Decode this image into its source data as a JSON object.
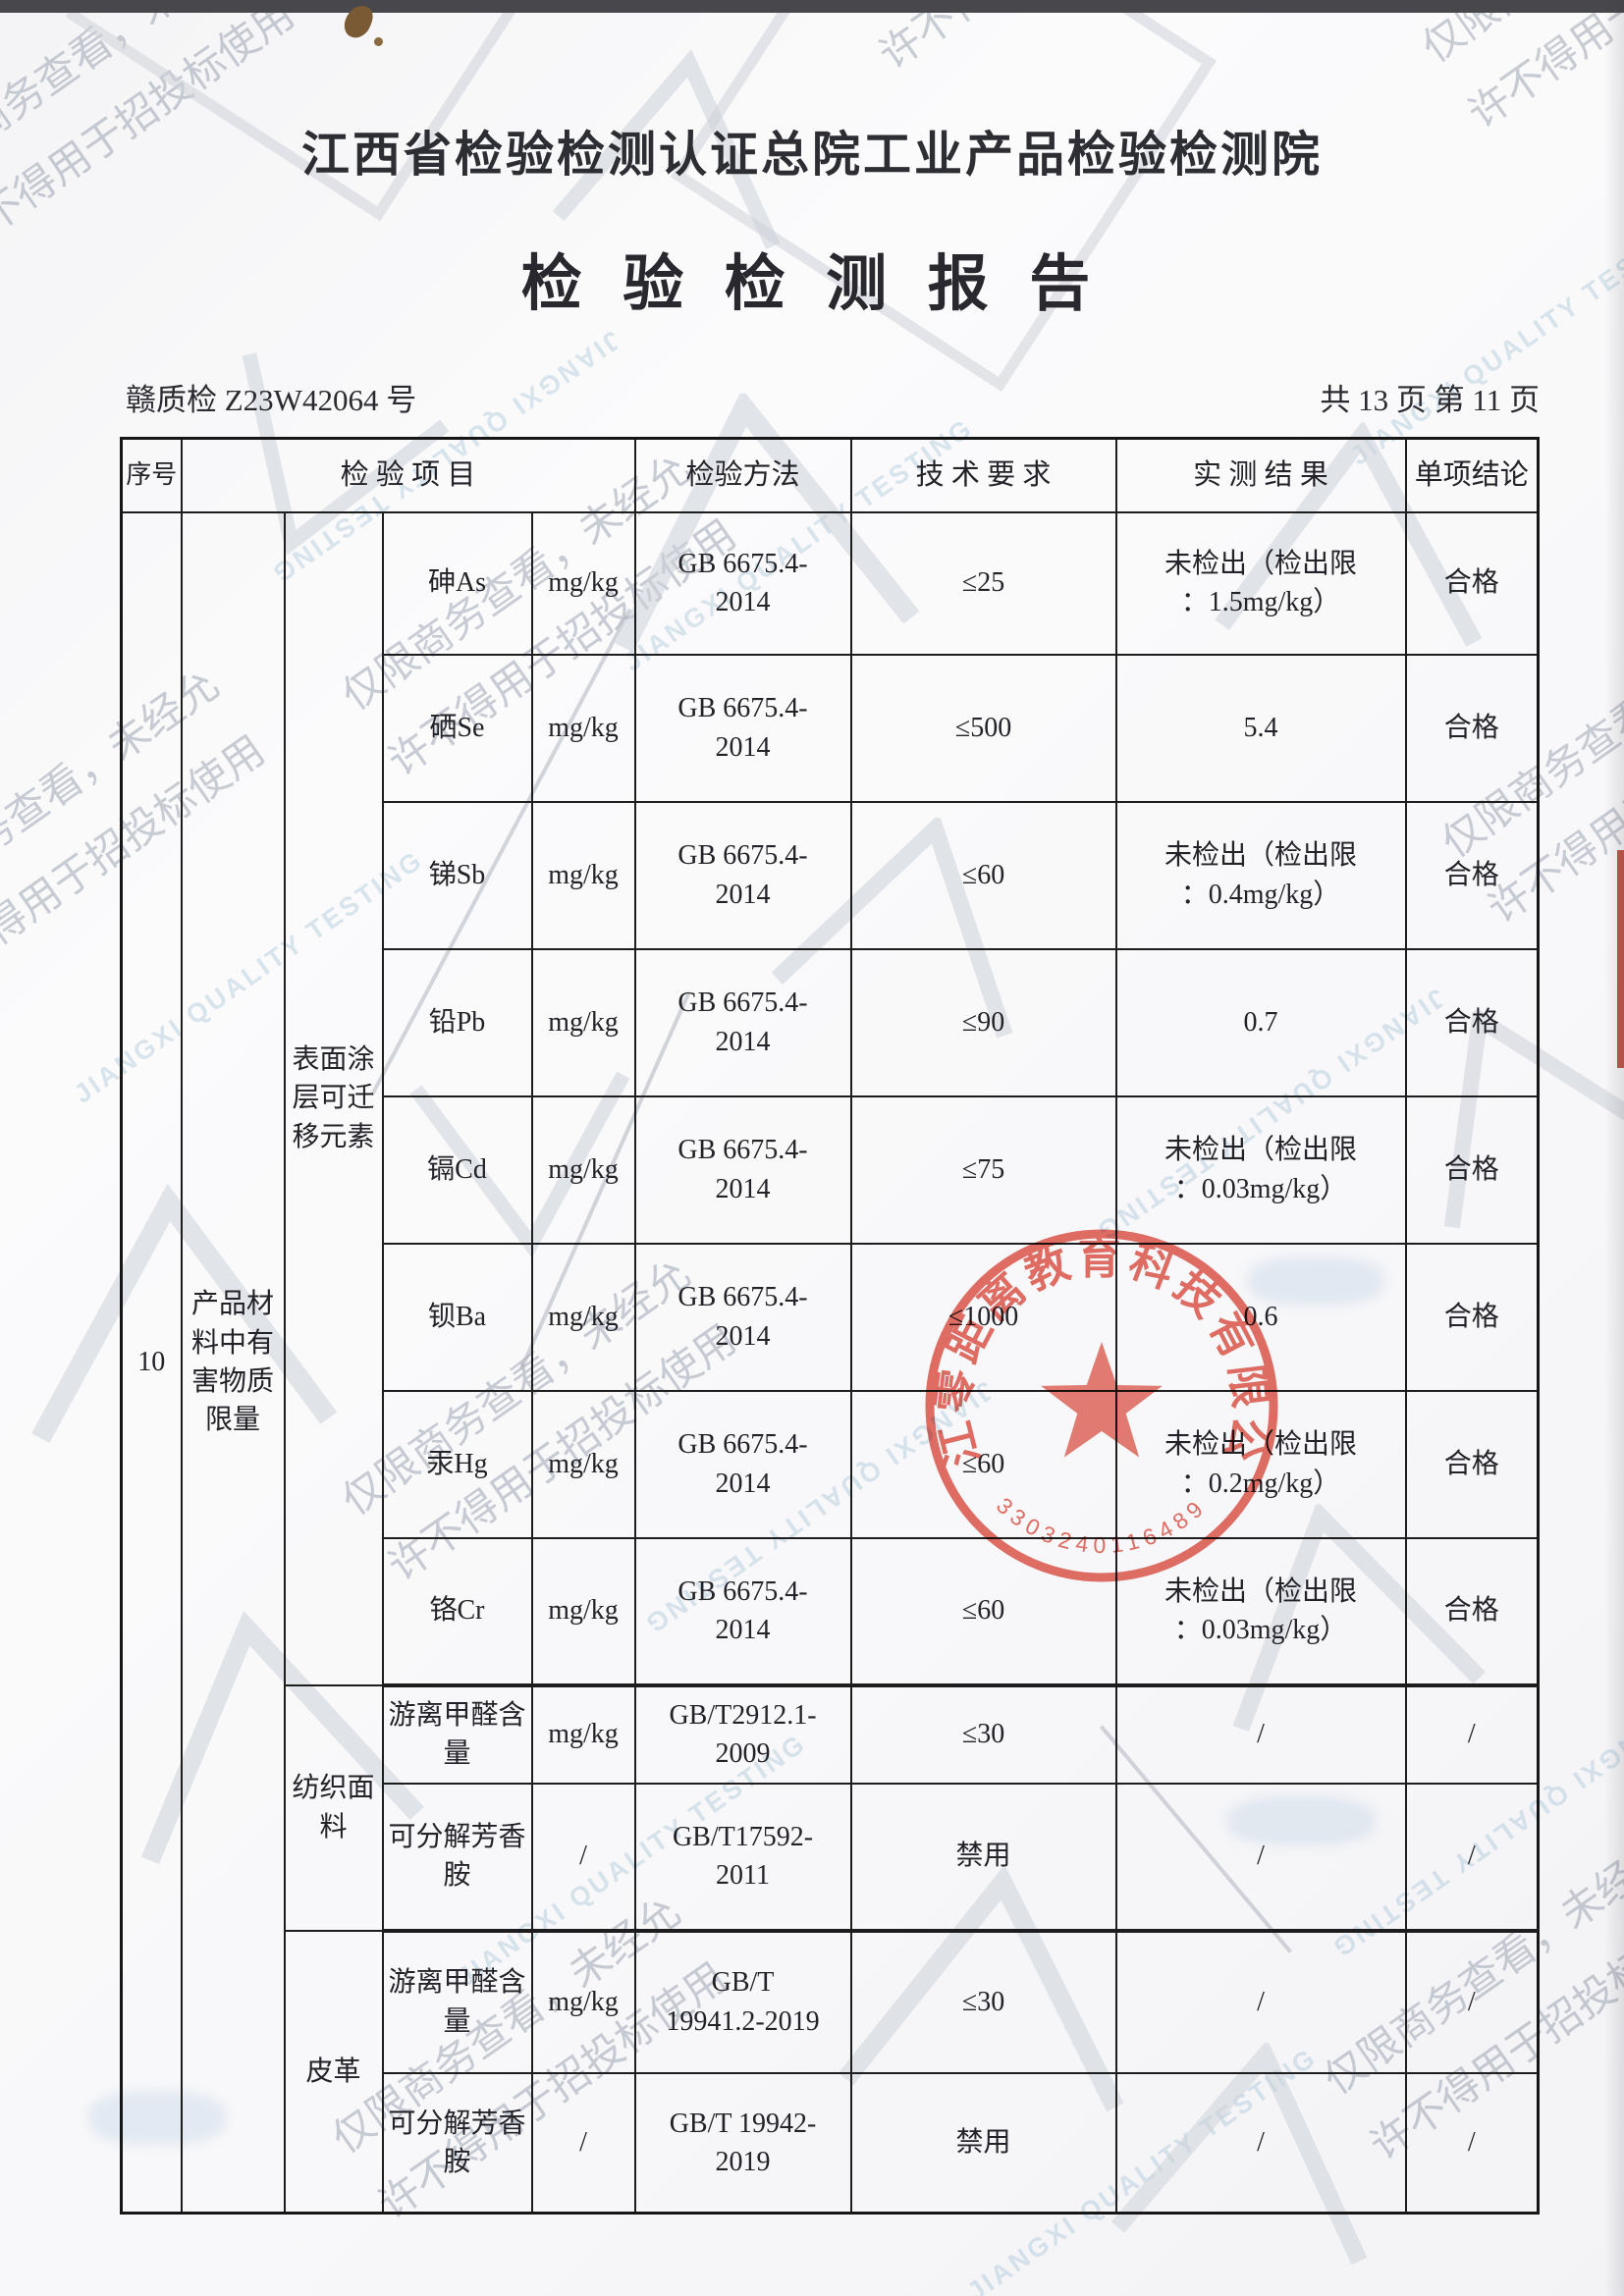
{
  "page": {
    "org_title": "江西省检验检测认证总院工业产品检验检测院",
    "report_title": "检 验 检 测 报 告",
    "report_no": "赣质检 Z23W42064 号",
    "page_info": "共 13 页 第 11 页"
  },
  "table": {
    "headers": {
      "seq": "序号",
      "item": "检 验 项 目",
      "method": "检验方法",
      "requirement": "技 术 要 求",
      "result": "实 测 结 果",
      "conclusion": "单项结论"
    },
    "seq": "10",
    "group": "产品材料中有害物质限量",
    "sections": [
      {
        "label": "表面涂层可迁移元素"
      },
      {
        "label": "纺织面料"
      },
      {
        "label": "皮革"
      }
    ],
    "rows": [
      {
        "name": "砷As",
        "unit": "mg/kg",
        "method": "GB 6675.4-\n2014",
        "requirement": "≤25",
        "result": "未检出（检出限\n：1.5mg/kg）",
        "conclusion": "合格"
      },
      {
        "name": "硒Se",
        "unit": "mg/kg",
        "method": "GB 6675.4-\n2014",
        "requirement": "≤500",
        "result": "5.4",
        "conclusion": "合格"
      },
      {
        "name": "锑Sb",
        "unit": "mg/kg",
        "method": "GB 6675.4-\n2014",
        "requirement": "≤60",
        "result": "未检出（检出限\n：0.4mg/kg）",
        "conclusion": "合格"
      },
      {
        "name": "铅Pb",
        "unit": "mg/kg",
        "method": "GB 6675.4-\n2014",
        "requirement": "≤90",
        "result": "0.7",
        "conclusion": "合格"
      },
      {
        "name": "镉Cd",
        "unit": "mg/kg",
        "method": "GB 6675.4-\n2014",
        "requirement": "≤75",
        "result": "未检出（检出限\n：0.03mg/kg）",
        "conclusion": "合格"
      },
      {
        "name": "钡Ba",
        "unit": "mg/kg",
        "method": "GB 6675.4-\n2014",
        "requirement": "≤1000",
        "result": "0.6",
        "conclusion": "合格"
      },
      {
        "name": "汞Hg",
        "unit": "mg/kg",
        "method": "GB 6675.4-\n2014",
        "requirement": "≤60",
        "result": "未检出（检出限\n：0.2mg/kg）",
        "conclusion": "合格"
      },
      {
        "name": "铬Cr",
        "unit": "mg/kg",
        "method": "GB 6675.4-\n2014",
        "requirement": "≤60",
        "result": "未检出（检出限\n：0.03mg/kg）",
        "conclusion": "合格"
      },
      {
        "name": "游离甲醛含量",
        "unit": "mg/kg",
        "method": "GB/T2912.1-\n2009",
        "requirement": "≤30",
        "result": "/",
        "conclusion": "/"
      },
      {
        "name": "可分解芳香胺",
        "unit": "/",
        "method": "GB/T17592-\n2011",
        "requirement": "禁用",
        "result": "/",
        "conclusion": "/"
      },
      {
        "name": "游离甲醛含量",
        "unit": "mg/kg",
        "method": "GB/T\n19941.2-2019",
        "requirement": "≤30",
        "result": "/",
        "conclusion": "/"
      },
      {
        "name": "可分解芳香胺",
        "unit": "/",
        "method": "GB/T 19942-\n2019",
        "requirement": "禁用",
        "result": "/",
        "conclusion": "/"
      }
    ]
  },
  "stamp": {
    "company": "浙江零距离教育科技有限公司",
    "serial": "3303240116489"
  },
  "watermarks": {
    "cn_line1": "仅限商务查看，未经允",
    "cn_line2": "许不得用于招投标使用",
    "en": "JIANGXI QUALITY TESTING"
  }
}
